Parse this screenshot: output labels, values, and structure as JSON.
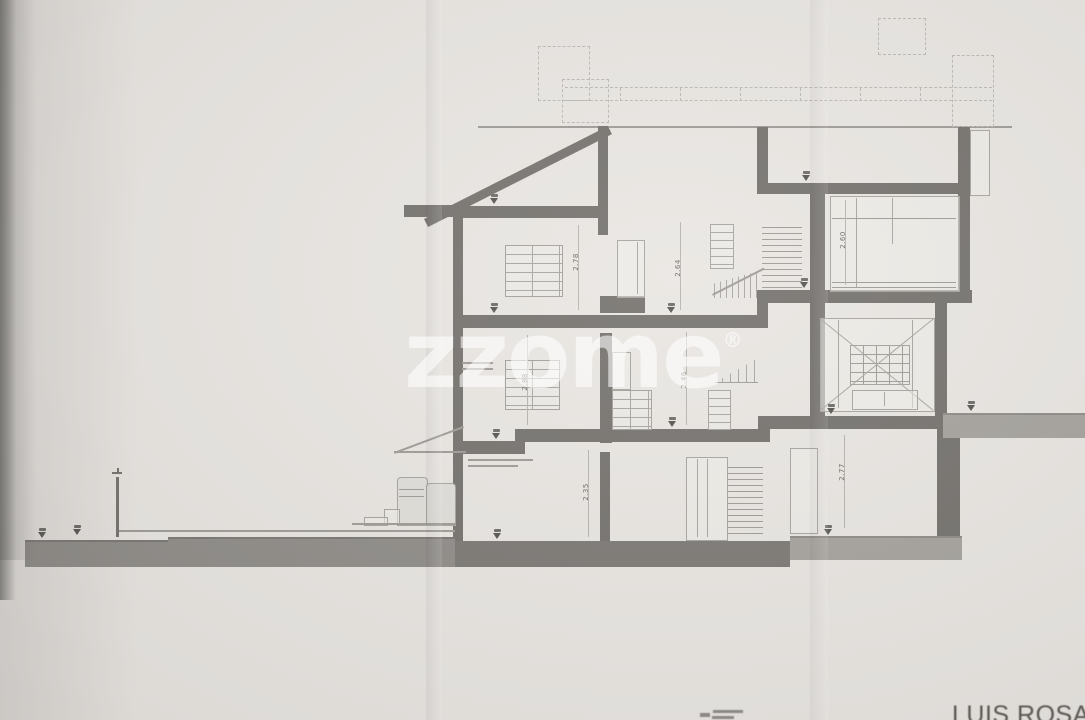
{
  "watermark": {
    "text": "zzome",
    "registered_mark": "®"
  },
  "signature": "LUIS ROSA V",
  "dimensions": {
    "top_left_room": "2.78",
    "top_center_room": "2.64",
    "top_right_room": "2.60",
    "mid_left_room": "2.88",
    "mid_center_room": "2.46",
    "ground_left_room": "2.35",
    "ground_right_room": "2.77"
  },
  "colors": {
    "paper": "#e9e6e2",
    "ink_wall": "#74716d",
    "ink_light": "#a7a49f",
    "foundation": "#7b7874",
    "terrain": "#8f8c88",
    "watermark_white": "rgba(255,255,255,0.58)",
    "signature_gray": "#5a5753"
  }
}
